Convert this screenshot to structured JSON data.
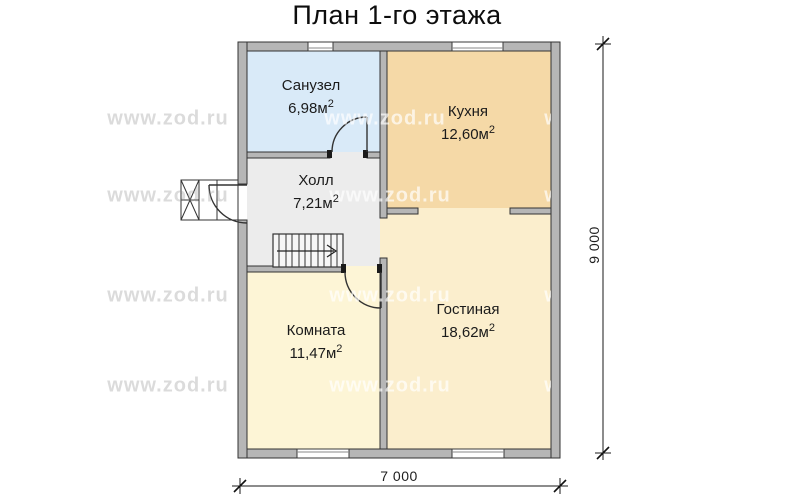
{
  "title": "План 1-го этажа",
  "watermark": "www.zod.ru",
  "rooms": {
    "bathroom": {
      "label": "Санузел",
      "area": "6,98м",
      "sup": "2",
      "color": "#d9eaf8"
    },
    "kitchen": {
      "label": "Кухня",
      "area": "12,60м",
      "sup": "2",
      "color": "#f5d9a7"
    },
    "hall": {
      "label": "Холл",
      "area": "7,21м",
      "sup": "2",
      "color": "#ececec"
    },
    "room": {
      "label": "Комната",
      "area": "11,47м",
      "sup": "2",
      "color": "#fdf5d6"
    },
    "living_room": {
      "label": "Гостиная",
      "area": "18,62м",
      "sup": "2",
      "color": "#fbeecd"
    }
  },
  "dimensions": {
    "vertical": "9 000",
    "horizontal": "7 000"
  },
  "colors": {
    "wall_fill": "#b6b6b6",
    "wall_stroke": "#333333"
  }
}
